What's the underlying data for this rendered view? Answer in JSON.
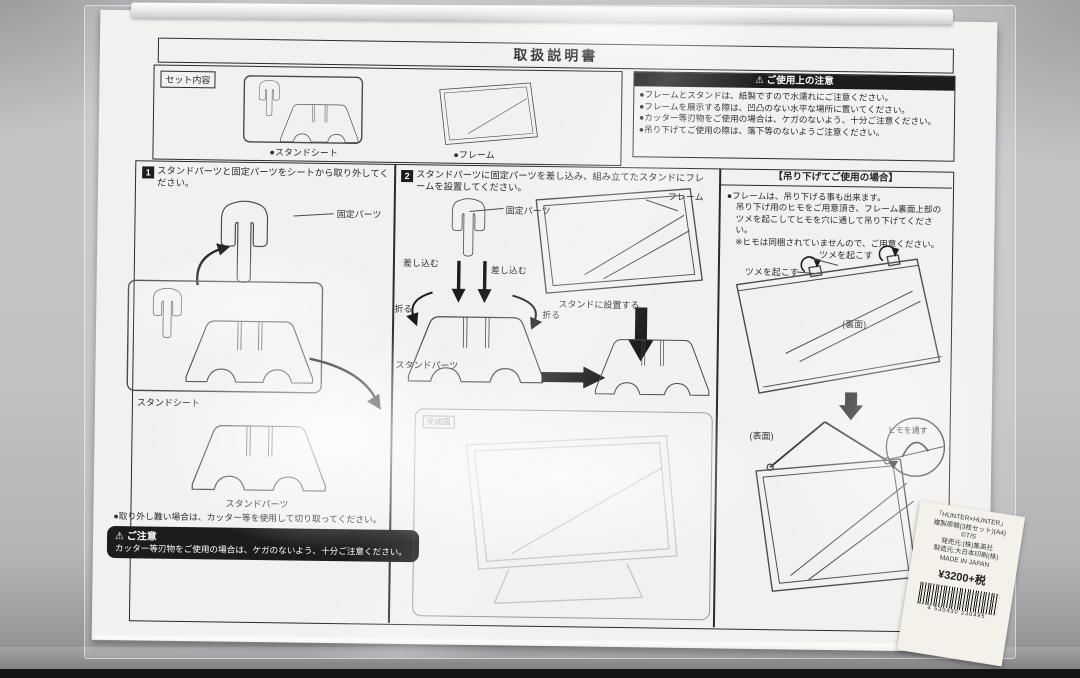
{
  "colors": {
    "ink": "#2a2a2a",
    "panel_black": "#1c1c1c",
    "paper": "#f2f1ef",
    "desk": "#c2c2c4"
  },
  "doc": {
    "title": "取扱説明書",
    "set_section": {
      "tag": "セット内容",
      "item1_label": "●スタンドシート",
      "item2_label": "●フレーム"
    },
    "notice": {
      "warn_icon": "⚠",
      "title": "ご使用上の注意",
      "lines": [
        "●フレームとスタンドは、紙製ですので水濡れにご注意ください。",
        "●フレームを展示する際は、凹凸のない水平な場所に置いてください。",
        "●カッター等刃物をご使用の場合は、ケガのないよう、十分ご注意ください。",
        "●吊り下げてご使用の際は、落下等のないようご注意ください。"
      ]
    },
    "step1": {
      "num": "1",
      "text": "スタンドパーツと固定パーツをシートから取り外してください。",
      "label_kotei": "固定パーツ",
      "label_sheet": "スタンドシート",
      "label_parts": "スタンドパーツ",
      "note": "●取り外し難い場合は、カッター等を使用して切り取ってください。"
    },
    "caution": {
      "icon": "⚠",
      "title": "ご注意",
      "text": "カッター等刃物をご使用の場合は、ケガのないよう、十分ご注意ください。"
    },
    "step2": {
      "num": "2",
      "text": "スタンドパーツに固定パーツを差し込み、組み立てたスタンドにフレームを設置してください。",
      "label_kotei": "固定パーツ",
      "label_sashikomu1": "差し込む",
      "label_sashikomu2": "差し込む",
      "label_oru1": "折る",
      "label_oru2": "折る",
      "label_parts": "スタンドパーツ",
      "label_frame": "フレーム",
      "label_setchi": "スタンドに設置する",
      "finished_tag": "完成図"
    },
    "hanging": {
      "title": "【吊り下げてご使用の場合】",
      "lines": [
        "●フレームは、吊り下げる事も出来ます。",
        "吊り下げ用のヒモをご用意頂き、フレーム裏面上部の",
        "ツメを起こしてヒモを穴に通して吊り下げてください。",
        "※ヒモは同梱されていませんので、ご用意ください。"
      ],
      "label_tsume_right": "ツメを起こす",
      "label_tsume_left": "ツメを起こす",
      "label_back": "(裏面)",
      "label_front": "(表面)",
      "label_himo": "ヒモを通す"
    },
    "price_label": {
      "lines": [
        "「HUNTER×HUNTER」",
        "複製原稿(3枚セット)(A4)",
        "©T/S",
        "発売元:(株)集英社",
        "製造元:大日本印刷(株)",
        "MADE IN JAPAN"
      ],
      "price": "¥3200+税",
      "barcode_digits": "4 530430 230495"
    }
  }
}
